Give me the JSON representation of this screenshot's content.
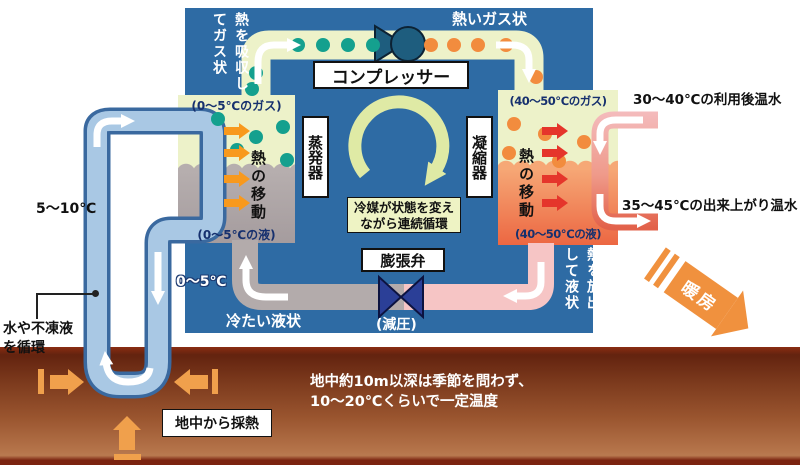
{
  "diagram": {
    "refrigerant_loop": {
      "compressor": "コンプレッサー",
      "evaporator": "蒸発器",
      "condenser": "凝縮器",
      "expansion_valve": "膨張弁",
      "decompression": "(減圧)",
      "hot_gas_state": "熱いガス状",
      "cold_liquid_state": "冷たい液状",
      "absorb_heat_note": "熱を吸収してガス状",
      "release_heat_note": "熱を放出して液状",
      "cycle_note_line1": "冷媒が状態を変え",
      "cycle_note_line2": "ながら連続循環",
      "evaporator_gas_label": "(0〜5℃のガス)",
      "evaporator_liquid_label": "(0〜5℃の液)",
      "condenser_gas_label": "(40〜50℃のガス)",
      "condenser_liquid_label": "(40〜50℃の液)",
      "heat_transfer_label": "熱の移動"
    },
    "ground_loop": {
      "supply_temp": "5〜10℃",
      "return_temp": "0〜5℃",
      "fluid_note_line1": "水や不凍液",
      "fluid_note_line2": "を循環",
      "extraction_label": "地中から採熱"
    },
    "heating_circuit": {
      "return_water": "30〜40℃の利用後温水",
      "supply_water": "35〜45℃の出来上がり温水",
      "heating_label": "暖房"
    },
    "ground": {
      "note_line1": "地中約10m以深は季節を問わず、",
      "note_line2": "10〜20℃くらいで一定温度"
    },
    "colors": {
      "panel_blue": "#2e6ba4",
      "pipe_gas": "#edf2c9",
      "teal_dot": "#14a08e",
      "orange_dot": "#f28c3e",
      "liquid_gray": "#b3abab",
      "hot_liquid": "#ee7a4c",
      "ground_pipe": "#a9c8e4",
      "warm_water": "#f4bcbe",
      "hot_water": "#e2705a",
      "heating_orange": "#f0913e",
      "heat_arrow_orange": "#f8991d",
      "heat_arrow_red": "#e5352b",
      "ground_arrow": "#f0a04c"
    }
  }
}
